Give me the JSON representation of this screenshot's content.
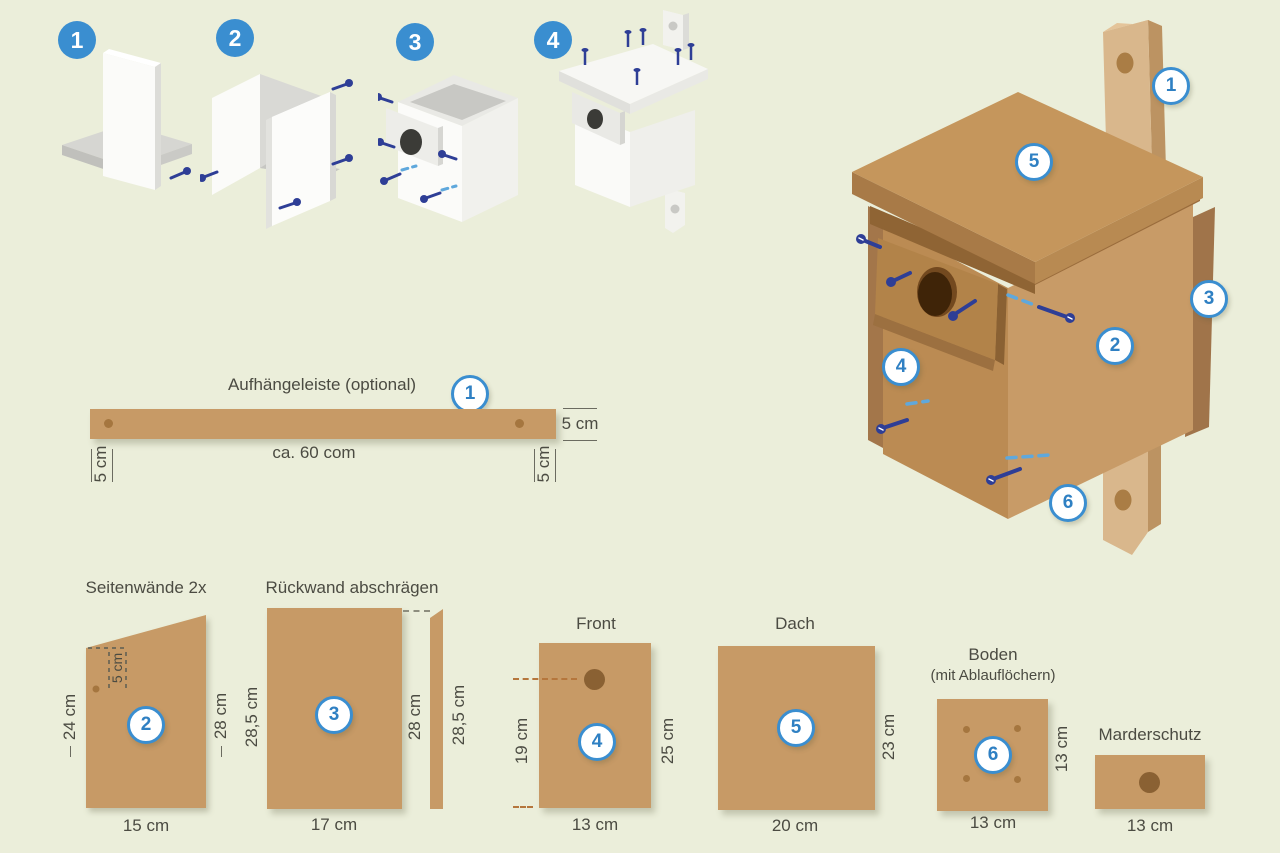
{
  "colors": {
    "background": "#ebeeda",
    "wood": "#c79a66",
    "wood_light": "#d9b78c",
    "wood_dark": "#a87a47",
    "accent_blue": "#3a8ed0",
    "screw_navy": "#2e3e96",
    "dash_blue": "#5fa8dc",
    "text": "#4b4b42"
  },
  "steps": {
    "one": "1",
    "two": "2",
    "three": "3",
    "four": "4"
  },
  "assembly": {
    "strip": "1",
    "side": "2",
    "back": "3",
    "front": "4",
    "roof": "5",
    "floor": "6"
  },
  "strip": {
    "title": "Aufhängeleiste (optional)",
    "badge": "1",
    "height": "5 cm",
    "length": "ca. 60 com",
    "left_offset": "5 cm",
    "right_offset": "5 cm"
  },
  "side": {
    "title": "Seitenwände 2x",
    "badge": "2",
    "hole_offset": "5 cm",
    "left": "24 cm",
    "right": "28 cm",
    "bottom": "15 cm"
  },
  "back": {
    "title": "Rückwand abschrägen",
    "badge": "3",
    "left": "28,5 cm",
    "mid": "28 cm",
    "right": "28,5 cm",
    "bottom": "17 cm"
  },
  "front": {
    "title": "Front",
    "badge": "4",
    "left": "19 cm",
    "right": "25 cm",
    "bottom": "13 cm"
  },
  "roof": {
    "title": "Dach",
    "badge": "5",
    "right": "23 cm",
    "bottom": "20 cm"
  },
  "floor": {
    "title": "Boden",
    "subtitle": "(mit Ablauflöchern)",
    "badge": "6",
    "right": "13 cm",
    "bottom": "13 cm"
  },
  "guard": {
    "title": "Marderschutz",
    "bottom": "13 cm"
  }
}
